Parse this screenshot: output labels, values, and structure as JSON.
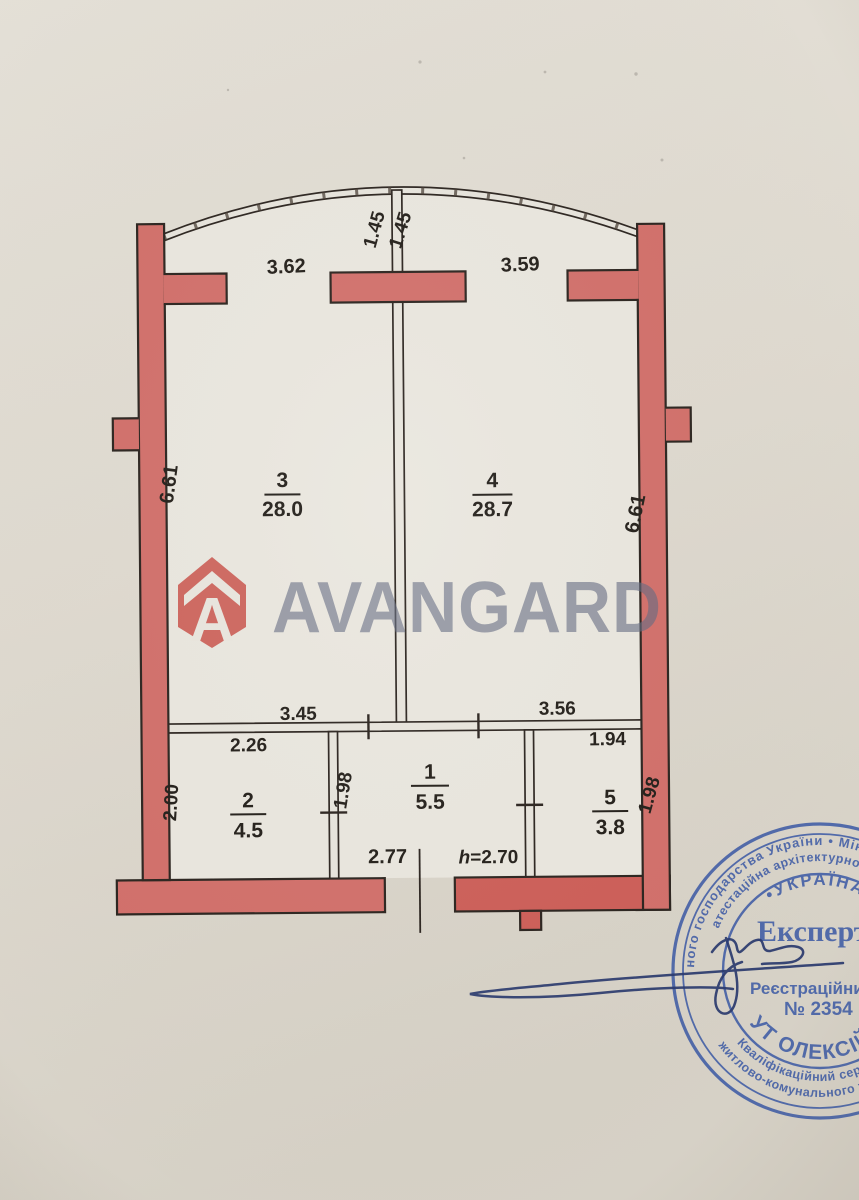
{
  "plan": {
    "dimensions": {
      "top_left": "3.62",
      "top_center_left": "1.45",
      "top_center_right": "1.45",
      "top_right": "3.59",
      "side_left": "6.61",
      "side_right": "6.61",
      "inner_left": "3.45",
      "inner_right": "3.56",
      "room2_width": "2.26",
      "room5_width": "1.94",
      "room2_depth": "2.00",
      "room1_depth": "1.98",
      "room5_depth": "1.98",
      "entry_width": "2.77",
      "height_symbol": "h",
      "height_value": "=2.70"
    },
    "rooms": [
      {
        "number": "3",
        "area": "28.0"
      },
      {
        "number": "4",
        "area": "28.7"
      },
      {
        "number": "2",
        "area": "4.5"
      },
      {
        "number": "1",
        "area": "5.5"
      },
      {
        "number": "5",
        "area": "3.8"
      }
    ],
    "colors": {
      "wall": "#d2706b",
      "wall_dark": "#cd5f59",
      "outline": "#2c2520",
      "interior": "#eae7df",
      "thin_wall": "#e8e5dd",
      "ink": "#24201b"
    }
  },
  "logo": {
    "brand": "AVANGARD",
    "icon_letter": "A",
    "icon_color": "rgba(196,62,54,0.82)",
    "text_color": "rgba(99,107,129,0.66)"
  },
  "stamp": {
    "color": "#3f5ca6",
    "ring_outer_top": "ного господарства України • Міністерс",
    "ring_inner_top": "атестаційна архітектурно-буд",
    "country": "•УКРАЇНА•",
    "ring_inner_bottom": "Кваліфікаційний сертифікат",
    "ring_outer_bottom": "житлово-комунального та саніт",
    "title": "Експерт",
    "registration_label": "Реєстраційний",
    "registration_number": "№ 2354",
    "expert_name": "УТ ОЛЕКСІЙ В"
  }
}
